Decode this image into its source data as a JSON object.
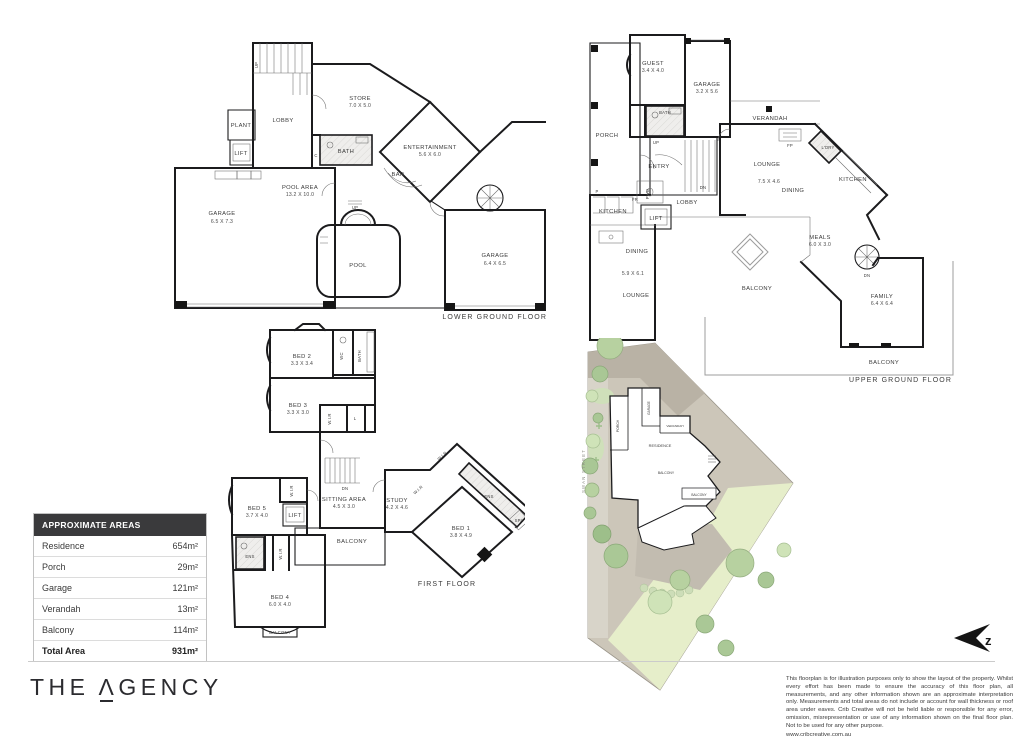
{
  "areas_table": {
    "header": "APPROXIMATE AREAS",
    "rows": [
      {
        "label": "Residence",
        "value": "654m²"
      },
      {
        "label": "Porch",
        "value": "29m²"
      },
      {
        "label": "Garage",
        "value": "121m²"
      },
      {
        "label": "Verandah",
        "value": "13m²"
      },
      {
        "label": "Balcony",
        "value": "114m²"
      }
    ],
    "total": {
      "label": "Total Area",
      "value": "931m²"
    }
  },
  "plans": {
    "lg": {
      "caption": "LOWER GROUND FLOOR",
      "rooms": {
        "lobby": {
          "label": "LOBBY"
        },
        "plant": {
          "label": "PLANT"
        },
        "lift": {
          "label": "LIFT"
        },
        "store": {
          "label": "STORE",
          "dims": "7.0 X 5.0"
        },
        "bath": {
          "label": "BATH"
        },
        "bar": {
          "label": "BAR"
        },
        "entertainment": {
          "label": "ENTERTAINMENT",
          "dims": "5.6 X 6.0"
        },
        "garage1": {
          "label": "GARAGE",
          "dims": "6.5 X 7.3"
        },
        "pool_area": {
          "label": "POOL AREA",
          "dims": "13.2 X 10.0"
        },
        "pool": {
          "label": "POOL"
        },
        "garage2": {
          "label": "GARAGE",
          "dims": "6.4 X 6.5"
        }
      },
      "small": {
        "up_stairs": "UP",
        "up_pool": "UP",
        "cupboard": "C"
      }
    },
    "ug": {
      "caption": "UPPER GROUND FLOOR",
      "rooms": {
        "porch": {
          "label": "PORCH"
        },
        "guest": {
          "label": "GUEST",
          "dims": "3.4 X 4.0"
        },
        "garage": {
          "label": "GARAGE",
          "dims": "3.2 X 5.6"
        },
        "bath": {
          "label": "BATH"
        },
        "entry": {
          "label": "ENTRY"
        },
        "lobby": {
          "label": "LOBBY"
        },
        "verandah": {
          "label": "VERANDAH"
        },
        "lounge_right": {
          "label": "LOUNGE",
          "dims": "7.5 X 4.6"
        },
        "dining_right": {
          "label": "DINING"
        },
        "laundry": {
          "label": "L'DRY"
        },
        "kitchen_right": {
          "label": "KITCHEN"
        },
        "meals": {
          "label": "MEALS",
          "dims": "6.0 X 3.0"
        },
        "kitchen_left": {
          "label": "KITCHEN"
        },
        "lift": {
          "label": "LIFT"
        },
        "dining_left": {
          "label": "DINING",
          "dims": "5.9 X 6.1"
        },
        "lounge_left": {
          "label": "LOUNGE"
        },
        "balcony_mid": {
          "label": "BALCONY"
        },
        "family": {
          "label": "FAMILY",
          "dims": "6.4 X 6.4"
        },
        "balcony_bottom": {
          "label": "BALCONY"
        }
      },
      "small": {
        "up": "UP",
        "dn_stairs": "DN",
        "dn_spiral": "DN",
        "fp": "FP",
        "p": "P",
        "pwd": "PWD",
        "fr": "FR"
      }
    },
    "ff": {
      "caption": "FIRST FLOOR",
      "rooms": {
        "bed2": {
          "label": "BED 2",
          "dims": "3.3 X 3.4"
        },
        "wc": {
          "label": "WC"
        },
        "bath": {
          "label": "BATH"
        },
        "bed3": {
          "label": "BED 3",
          "dims": "3.3 X 3.0"
        },
        "wir_bed3": {
          "label": "W.I.R"
        },
        "linen": {
          "label": "L"
        },
        "sitting": {
          "label": "SITTING AREA",
          "dims": "4.5 X 3.0"
        },
        "study": {
          "label": "STUDY",
          "dims": "4.2 X 4.6"
        },
        "wir_top": {
          "label": "W.I.R"
        },
        "wir_study": {
          "label": "W.I.R"
        },
        "ens_bed1": {
          "label": "ENS"
        },
        "spa": {
          "label": "SPA"
        },
        "bed1": {
          "label": "BED 1",
          "dims": "3.8 X 4.9"
        },
        "balcony_mid": {
          "label": "BALCONY"
        },
        "bed5": {
          "label": "BED 5",
          "dims": "3.7 X 4.0"
        },
        "wir_bed5": {
          "label": "W.I.R"
        },
        "lift": {
          "label": "LIFT"
        },
        "ens_bed5": {
          "label": "ENS"
        },
        "wir_bed4": {
          "label": "W.I.R"
        },
        "bed4": {
          "label": "BED 4",
          "dims": "6.0 X 4.0"
        },
        "balcony_bottom": {
          "label": "BALCONY"
        }
      },
      "small": {
        "dn": "DN"
      }
    }
  },
  "site_plan": {
    "street": "SWAN STREET",
    "labels": {
      "porch": "PORCH",
      "garage": "GARAGE",
      "verandah": "VERANDAH",
      "residence": "RESIDENCE",
      "balcony_a": "BALCONY",
      "balcony_b": "BALCONY"
    }
  },
  "compass": {
    "letter": "z"
  },
  "footer": {
    "brand": {
      "the": "THE",
      "a": "Λ",
      "gency": "GENCY"
    },
    "disclaimer": "This floorplan is for illustration purposes only to show the layout of the property. Whilst every effort has been made to ensure the accuracy of this floor plan, all measurements, and any other information shown are an approximate interpretation only. Measurements and total areas do not include or account for wall thickness or roof area under eaves. Crib Creative will not be held liable or responsible for any error, omission, misrepresentation or use of any information shown on the final floor plan. Not to be used for any other purpose.",
    "website": "www.cribcreative.com.au"
  }
}
